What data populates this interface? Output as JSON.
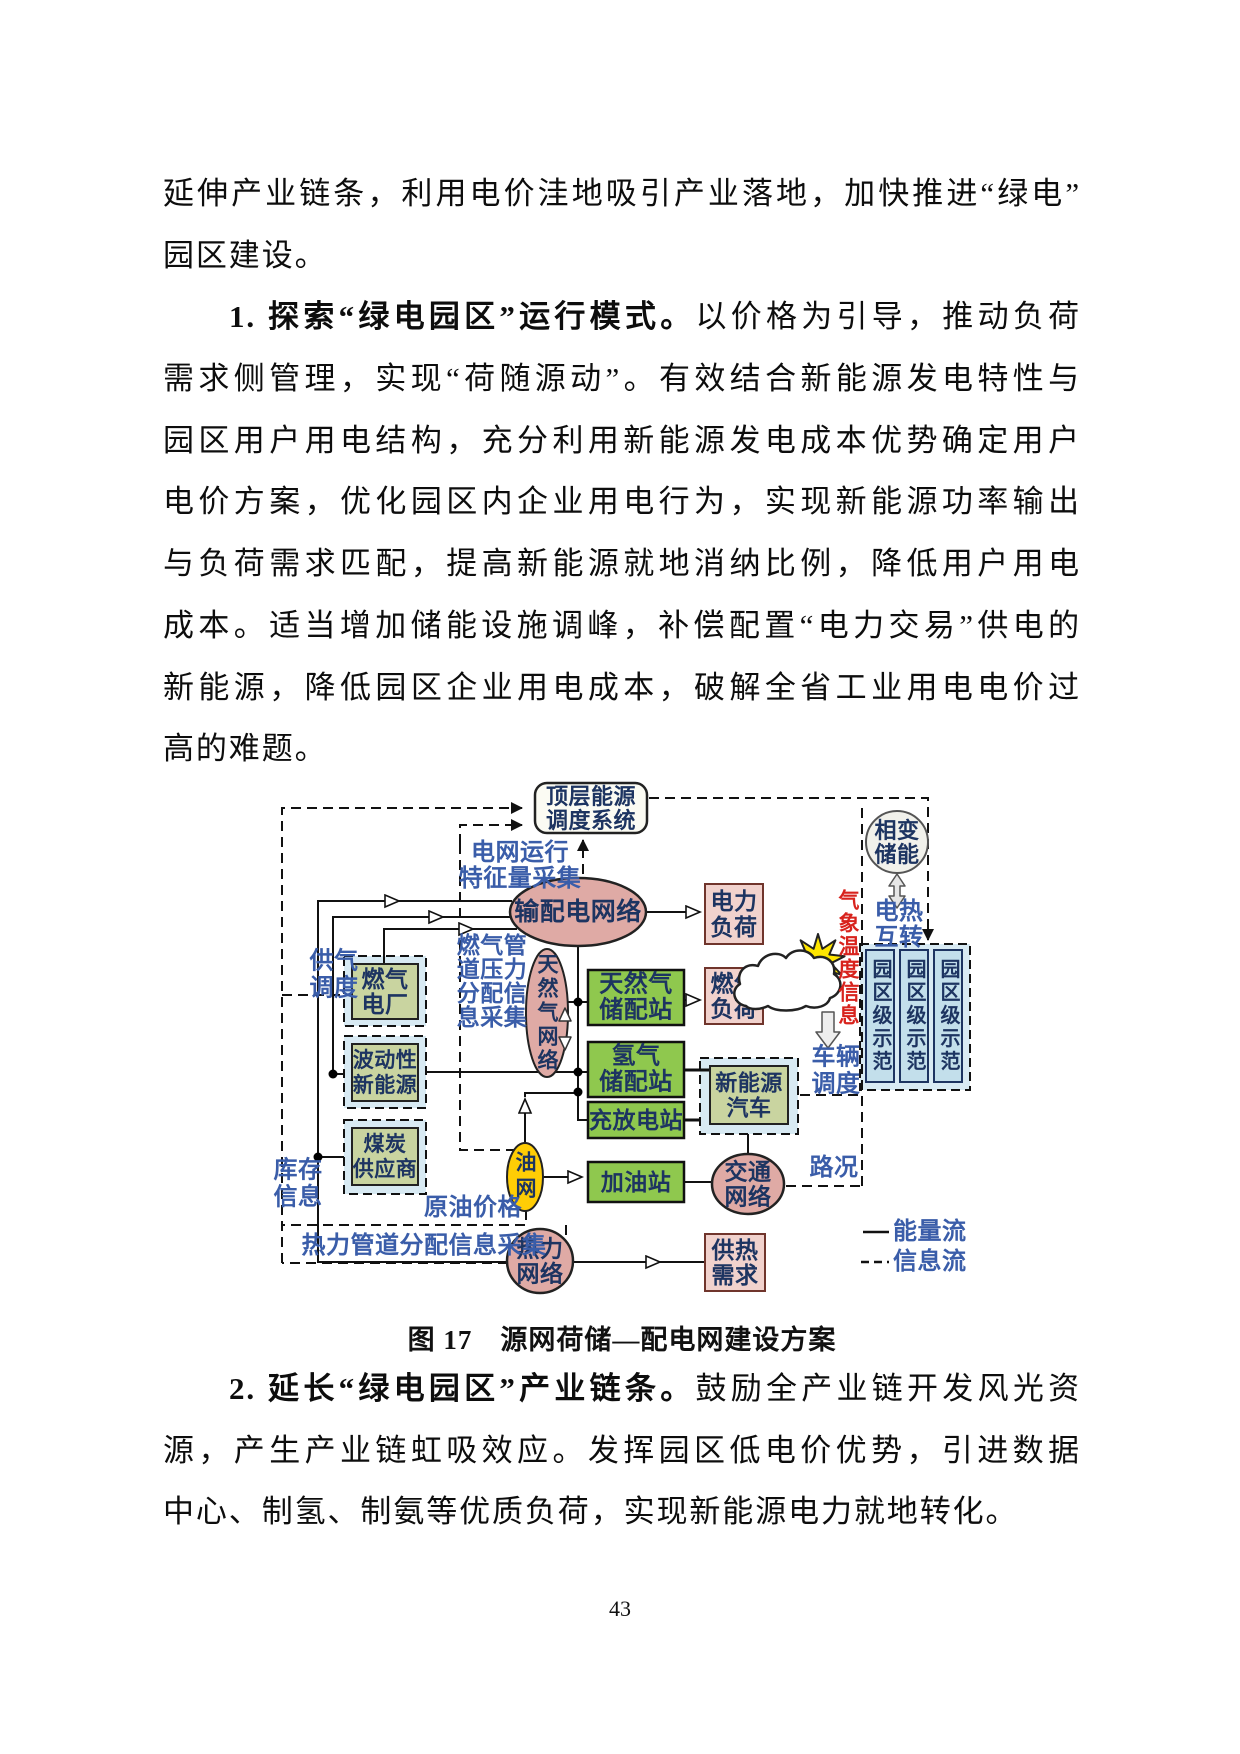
{
  "page": {
    "number": "43"
  },
  "body_text": {
    "top_lines": [
      {
        "segments": [
          {
            "t": "延伸产业链条，利用电价洼地吸引产业落地，加快推进“绿电”",
            "b": false
          }
        ],
        "indent": false,
        "last": false
      },
      {
        "segments": [
          {
            "t": "园区建设。",
            "b": false
          }
        ],
        "indent": false,
        "last": true
      },
      {
        "segments": [
          {
            "t": "1. 探索“绿电园区”运行模式。",
            "b": true
          },
          {
            "t": "以价格为引导，推动负荷",
            "b": false
          }
        ],
        "indent": true,
        "last": false
      },
      {
        "segments": [
          {
            "t": "需求侧管理，实现“荷随源动”。有效结合新能源发电特性与",
            "b": false
          }
        ],
        "indent": false,
        "last": false
      },
      {
        "segments": [
          {
            "t": "园区用户用电结构，充分利用新能源发电成本优势确定用户",
            "b": false
          }
        ],
        "indent": false,
        "last": false
      },
      {
        "segments": [
          {
            "t": "电价方案，优化园区内企业用电行为，实现新能源功率输出",
            "b": false
          }
        ],
        "indent": false,
        "last": false
      },
      {
        "segments": [
          {
            "t": "与负荷需求匹配，提高新能源就地消纳比例，降低用户用电",
            "b": false
          }
        ],
        "indent": false,
        "last": false
      },
      {
        "segments": [
          {
            "t": "成本。适当增加储能设施调峰，补偿配置“电力交易”供电的",
            "b": false
          }
        ],
        "indent": false,
        "last": false
      },
      {
        "segments": [
          {
            "t": "新能源，降低园区企业用电成本，破解全省工业用电电价过",
            "b": false
          }
        ],
        "indent": false,
        "last": false
      },
      {
        "segments": [
          {
            "t": "高的难题。",
            "b": false
          }
        ],
        "indent": false,
        "last": true
      }
    ],
    "bottom_lines": [
      {
        "segments": [
          {
            "t": "2. 延长“绿电园区”产业链条。",
            "b": true
          },
          {
            "t": "鼓励全产业链开发风光资",
            "b": false
          }
        ],
        "indent": true,
        "last": false
      },
      {
        "segments": [
          {
            "t": "源，产生产业链虹吸效应。发挥园区低电价优势，引进数据",
            "b": false
          }
        ],
        "indent": false,
        "last": false
      },
      {
        "segments": [
          {
            "t": "中心、制氢、制氨等优质负荷，实现新能源电力就地转化。",
            "b": false
          }
        ],
        "indent": false,
        "last": true
      }
    ]
  },
  "figure": {
    "caption": "图 17　源网荷储—配电网建设方案",
    "palette": {
      "pink_node": "#dfaaa5",
      "pink_box": "#f1d2cd",
      "pink_box_border": "#70352c",
      "green_box": "#8fc84e",
      "olive_box": "#c9d4a0",
      "container": "#d8eaf3",
      "demo_box": "#c3dfeb",
      "navy": "#1d3461",
      "blue": "#3a5da9",
      "red": "#d8231d",
      "yellow": "#ffcd05",
      "top_box": "#fbfbf3",
      "storage": "#f1f1eb"
    },
    "containers": [
      {
        "name": "gas-plant-container",
        "x": 344,
        "y": 956,
        "w": 82,
        "h": 70
      },
      {
        "name": "renewables-container",
        "x": 344,
        "y": 1036,
        "w": 82,
        "h": 72
      },
      {
        "name": "coal-container",
        "x": 344,
        "y": 1120,
        "w": 82,
        "h": 74
      },
      {
        "name": "ev-container",
        "x": 700,
        "y": 1058,
        "w": 98,
        "h": 76
      },
      {
        "name": "park-demo-container",
        "x": 860,
        "y": 944,
        "w": 110,
        "h": 146
      }
    ],
    "edges": [
      {
        "name": "info-outer-boundary",
        "d": "M282,1263 L282,808 L522,808",
        "kind": "info",
        "arrow": "filled"
      },
      {
        "name": "info-inner-boundary-arrow",
        "d": "M460,844 L460,825 L522,825",
        "kind": "info",
        "arrow": "filled"
      },
      {
        "name": "info-inner-boundary",
        "d": "M460,844 L460,1150 L526,1150 L526,1225 L282,1225",
        "kind": "info"
      },
      {
        "name": "info-label-box",
        "d": "M566,1225 L566,1263 L282,1263",
        "kind": "info"
      },
      {
        "name": "info-top-right",
        "d": "M649,798 L928,798 L928,940",
        "kind": "info",
        "arrow": "filled"
      },
      {
        "name": "info-right-boundary",
        "d": "M862,808 L862,1186",
        "kind": "info"
      },
      {
        "name": "info-traffic-link",
        "d": "M786,1186 L862,1186",
        "kind": "info"
      },
      {
        "name": "info-grid-feature-arrow",
        "d": "M583,874 L583,840",
        "kind": "info",
        "arrow": "filled"
      },
      {
        "name": "info-vehicle-link",
        "d": "M800,1095 L860,1095",
        "kind": "info"
      },
      {
        "name": "info-gas-supply-link",
        "d": "M282,995 L344,995",
        "kind": "info"
      },
      {
        "name": "energy-coal-riser",
        "d": "M318,1157 L318,901 L398,901",
        "kind": "energy",
        "arrow": "hollow"
      },
      {
        "name": "energy-coal-riser-2",
        "d": "M398,901 L512,901",
        "kind": "energy"
      },
      {
        "name": "energy-renew-riser",
        "d": "M333,1074 L333,917 L442,917",
        "kind": "energy",
        "arrow": "hollow"
      },
      {
        "name": "energy-renew-riser-2",
        "d": "M442,917 L514,917",
        "kind": "energy"
      },
      {
        "name": "energy-gasplant-up",
        "d": "M384,964 L384,929 L472,929",
        "kind": "energy",
        "arrow": "hollow"
      },
      {
        "name": "energy-gasplant-up-2",
        "d": "M472,929 L517,929",
        "kind": "energy"
      },
      {
        "name": "energy-renew-stub",
        "d": "M333,1074 L344,1074",
        "kind": "energy"
      },
      {
        "name": "energy-coal-stub",
        "d": "M318,1157 L344,1157",
        "kind": "energy"
      },
      {
        "name": "energy-left-down",
        "d": "M318,1157 L318,1262 L509,1262",
        "kind": "energy"
      },
      {
        "name": "energy-grid-to-load",
        "d": "M646,912 L699,912",
        "kind": "energy",
        "arrow": "hollow"
      },
      {
        "name": "energy-grid-down",
        "d": "M578,946 L578,1120 L588,1120",
        "kind": "energy"
      },
      {
        "name": "energy-gasnet-station",
        "d": "M568,1002 L588,1002",
        "kind": "energy"
      },
      {
        "name": "energy-renew-h2",
        "d": "M426,1072 L588,1072",
        "kind": "energy"
      },
      {
        "name": "energy-ngstation-gasload",
        "d": "M684,1000 L699,1000",
        "kind": "energy",
        "arrow": "hollow"
      },
      {
        "name": "energy-h2-vehicle",
        "d": "M684,1070 L710,1070",
        "kind": "energy",
        "w": 3
      },
      {
        "name": "energy-charge-vehicle",
        "d": "M684,1120 L700,1120",
        "kind": "energy",
        "w": 3
      },
      {
        "name": "energy-vehicle-traffic",
        "d": "M748,1134 L748,1155",
        "kind": "energy"
      },
      {
        "name": "energy-oil-up",
        "d": "M525,1143 L525,1100",
        "kind": "energy",
        "arrow": "hollow"
      },
      {
        "name": "energy-oil-up-2",
        "d": "M525,1097 L525,1093 L576,1093",
        "kind": "energy"
      },
      {
        "name": "energy-oil-fuelstation",
        "d": "M543,1177 L581,1177",
        "kind": "energy",
        "arrow": "hollow"
      },
      {
        "name": "energy-fuel-traffic",
        "d": "M684,1182 L713,1182",
        "kind": "energy"
      },
      {
        "name": "energy-heat-demand",
        "d": "M573,1262 L659,1262",
        "kind": "energy",
        "arrow": "hollow"
      },
      {
        "name": "energy-heat-demand-2",
        "d": "M659,1262 L705,1262",
        "kind": "energy"
      }
    ],
    "dots": [
      [
        333,
        1074
      ],
      [
        318,
        1157
      ],
      [
        578,
        1002
      ],
      [
        578,
        1072
      ],
      [
        578,
        1092
      ]
    ],
    "nodes": [
      {
        "name": "top-dispatch-system",
        "shape": "roundrect",
        "x": 535,
        "y": 783,
        "w": 112,
        "h": 50,
        "rx": 12,
        "fill": "top_box",
        "stroke": "#222",
        "sw": 2.5,
        "lines": [
          "顶层能源",
          "调度系统"
        ],
        "fs": 22,
        "lh": 24
      },
      {
        "name": "grid-network",
        "shape": "ellipse",
        "cx": 578,
        "cy": 912,
        "rx": 68,
        "ry": 34,
        "fill": "pink_node",
        "stroke": "#222",
        "sw": 2.5,
        "lines": [
          "输配电网络"
        ],
        "fs": 25,
        "lh": 26
      },
      {
        "name": "power-load",
        "shape": "rect",
        "x": 705,
        "y": 884,
        "w": 58,
        "h": 60,
        "fill": "pink_box",
        "stroke": "#70352c",
        "sw": 2,
        "lines": [
          "电力",
          "负荷"
        ],
        "fs": 23,
        "lh": 26
      },
      {
        "name": "gas-load",
        "shape": "rect",
        "x": 705,
        "y": 968,
        "w": 58,
        "h": 56,
        "fill": "pink_box",
        "stroke": "#70352c",
        "sw": 2,
        "lines": [
          "燃气",
          "负荷"
        ],
        "fs": 23,
        "lh": 25
      },
      {
        "name": "heat-demand",
        "shape": "rect",
        "x": 705,
        "y": 1234,
        "w": 60,
        "h": 57,
        "fill": "pink_box",
        "stroke": "#70352c",
        "sw": 2,
        "lines": [
          "供热",
          "需求"
        ],
        "fs": 23,
        "lh": 25
      },
      {
        "name": "naturalgas-network",
        "shape": "ellipse",
        "cx": 547,
        "cy": 1013,
        "rx": 21,
        "ry": 64,
        "fill": "pink_node",
        "stroke": "#222",
        "sw": 2,
        "lines": [
          "天然气网络"
        ],
        "fs": 21,
        "vertical": true,
        "ls": 3
      },
      {
        "name": "naturalgas-station",
        "shape": "rect",
        "x": 588,
        "y": 970,
        "w": 96,
        "h": 55,
        "fill": "green_box",
        "stroke": "#111",
        "sw": 2.5,
        "lines": [
          "天然气",
          "储配站"
        ],
        "fs": 24,
        "lh": 26
      },
      {
        "name": "hydrogen-station",
        "shape": "rect",
        "x": 588,
        "y": 1042,
        "w": 96,
        "h": 55,
        "fill": "green_box",
        "stroke": "#111",
        "sw": 2.5,
        "lines": [
          "氢气",
          "储配站"
        ],
        "fs": 24,
        "lh": 26
      },
      {
        "name": "charge-station",
        "shape": "rect",
        "x": 588,
        "y": 1102,
        "w": 96,
        "h": 36,
        "fill": "green_box",
        "stroke": "#111",
        "sw": 2.5,
        "lines": [
          "充放电站"
        ],
        "fs": 23,
        "lh": 24
      },
      {
        "name": "fuel-station",
        "shape": "rect",
        "x": 588,
        "y": 1162,
        "w": 96,
        "h": 40,
        "fill": "green_box",
        "stroke": "#111",
        "sw": 2.5,
        "lines": [
          "加油站"
        ],
        "fs": 23,
        "lh": 24
      },
      {
        "name": "gas-power-plant",
        "shape": "rect",
        "x": 352,
        "y": 964,
        "w": 66,
        "h": 55,
        "fill": "olive_box",
        "stroke": "#222",
        "sw": 2,
        "lines": [
          "燃气",
          "电厂"
        ],
        "fs": 23,
        "lh": 25
      },
      {
        "name": "fluctuating-renewables",
        "shape": "rect",
        "x": 352,
        "y": 1044,
        "w": 66,
        "h": 57,
        "fill": "olive_box",
        "stroke": "#222",
        "sw": 2,
        "lines": [
          "波动性",
          "新能源"
        ],
        "fs": 21,
        "lh": 25
      },
      {
        "name": "coal-supplier",
        "shape": "rect",
        "x": 352,
        "y": 1128,
        "w": 66,
        "h": 57,
        "fill": "olive_box",
        "stroke": "#222",
        "sw": 2,
        "lines": [
          "煤炭",
          "供应商"
        ],
        "fs": 21,
        "lh": 25
      },
      {
        "name": "new-energy-vehicle",
        "shape": "rect",
        "x": 710,
        "y": 1066,
        "w": 78,
        "h": 58,
        "fill": "olive_box",
        "stroke": "#222",
        "sw": 2,
        "lines": [
          "新能源",
          "汽车"
        ],
        "fs": 22,
        "lh": 25
      },
      {
        "name": "oil-network",
        "shape": "ellipse",
        "cx": 525,
        "cy": 1177,
        "rx": 18,
        "ry": 34,
        "fill": "yellow",
        "stroke": "#222",
        "sw": 2,
        "lines": [
          "油网"
        ],
        "fs": 21,
        "vertical": true,
        "ls": 5
      },
      {
        "name": "traffic-network",
        "shape": "ellipse",
        "cx": 748,
        "cy": 1184,
        "rx": 36,
        "ry": 30,
        "fill": "pink_node",
        "stroke": "#222",
        "sw": 2.5,
        "lines": [
          "交通",
          "网络"
        ],
        "fs": 23,
        "lh": 25
      },
      {
        "name": "heat-network",
        "shape": "ellipse",
        "cx": 540,
        "cy": 1261,
        "rx": 33,
        "ry": 32,
        "fill": "pink_node",
        "stroke": "#222",
        "sw": 2.5,
        "lines": [
          "热力",
          "网络"
        ],
        "fs": 23,
        "lh": 25
      },
      {
        "name": "phase-change-storage",
        "shape": "circle",
        "cx": 897,
        "cy": 842,
        "r": 31,
        "fill": "storage",
        "stroke": "#555",
        "sw": 2,
        "lines": [
          "相变",
          "储能"
        ],
        "fs": 22,
        "lh": 24
      },
      {
        "name": "park-demo-1",
        "shape": "rect",
        "x": 866,
        "y": 950,
        "w": 28,
        "h": 132,
        "fill": "demo_box",
        "stroke": "#1d3461",
        "sw": 2,
        "lines": [
          "园区级示范"
        ],
        "fs": 20,
        "vertical": true,
        "ls": 3
      },
      {
        "name": "park-demo-2",
        "shape": "rect",
        "x": 900,
        "y": 950,
        "w": 28,
        "h": 132,
        "fill": "demo_box",
        "stroke": "#1d3461",
        "sw": 2,
        "lines": [
          "园区级示范"
        ],
        "fs": 20,
        "vertical": true,
        "ls": 3
      },
      {
        "name": "park-demo-3",
        "shape": "rect",
        "x": 934,
        "y": 950,
        "w": 28,
        "h": 132,
        "fill": "demo_box",
        "stroke": "#1d3461",
        "sw": 2,
        "lines": [
          "园区级示范"
        ],
        "fs": 20,
        "vertical": true,
        "ls": 3
      }
    ],
    "labels": [
      {
        "name": "label-grid-feature-collection",
        "x": 520,
        "y": 866,
        "lines": [
          "电网运行",
          "特征量采集"
        ],
        "color": "blue",
        "fs": 24,
        "lh": 26
      },
      {
        "name": "label-gas-supply-dispatch",
        "x": 334,
        "y": 975,
        "lines": [
          "供气",
          "调度"
        ],
        "color": "blue",
        "fs": 24,
        "lh": 27
      },
      {
        "name": "label-gas-pipeline-info",
        "x": 492,
        "y": 981,
        "lines": [
          "燃气管",
          "道压力",
          "分配信",
          "息采集"
        ],
        "color": "blue",
        "fs": 23,
        "lh": 24
      },
      {
        "name": "label-inventory-info",
        "x": 298,
        "y": 1184,
        "lines": [
          "库存",
          "信息"
        ],
        "color": "blue",
        "fs": 24,
        "lh": 27
      },
      {
        "name": "label-crude-oil-price",
        "x": 473,
        "y": 1208,
        "lines": [
          "原油价格"
        ],
        "color": "blue",
        "fs": 24,
        "lh": 26
      },
      {
        "name": "label-heat-pipeline-info",
        "x": 424,
        "y": 1246,
        "lines": [
          "热力管道分配信息采集"
        ],
        "color": "blue",
        "fs": 24,
        "lh": 26
      },
      {
        "name": "label-vehicle-dispatch",
        "x": 836,
        "y": 1071,
        "lines": [
          "车辆",
          "调度"
        ],
        "color": "blue",
        "fs": 24,
        "lh": 27
      },
      {
        "name": "label-electric-heat-convert",
        "x": 899,
        "y": 925,
        "lines": [
          "电热",
          "互转"
        ],
        "color": "blue",
        "fs": 24,
        "lh": 26
      },
      {
        "name": "label-road-condition",
        "x": 834,
        "y": 1168,
        "lines": [
          "路况"
        ],
        "color": "blue",
        "fs": 24,
        "lh": 26
      },
      {
        "name": "label-weather-temperature-info",
        "x": 848,
        "y": 958,
        "lines": [
          "气象温度信息"
        ],
        "color": "red",
        "fs": 21,
        "vertical": true,
        "ls": 2
      },
      {
        "name": "legend-energy-flow-label",
        "x": 893,
        "y": 1232,
        "lines": [
          "能量流"
        ],
        "color": "blue",
        "fs": 24,
        "lh": 26,
        "anchor": "start"
      },
      {
        "name": "legend-info-flow-label",
        "x": 893,
        "y": 1262,
        "lines": [
          "信息流"
        ],
        "color": "blue",
        "fs": 24,
        "lh": 26,
        "anchor": "start"
      }
    ],
    "shapes": [
      {
        "name": "sun-icon",
        "type": "star",
        "cx": 818,
        "cy": 961,
        "r1": 13,
        "r2": 27,
        "points": 9,
        "fill": "#ffe600",
        "stroke": "#222",
        "sw": 2
      },
      {
        "name": "cloud-icon",
        "type": "path",
        "d": "M746,1006 C734,1004 730,990 740,984 C736,972 746,962 758,966 C762,954 778,950 786,958 C792,948 808,948 814,958 C826,954 836,962 834,974 C844,980 842,994 830,998 C828,1006 816,1010 806,1006 C796,1012 776,1012 768,1006 C760,1010 750,1010 746,1006 Z",
        "fill": "#ffffff",
        "stroke": "#222",
        "sw": 2.5
      },
      {
        "name": "phase-storage-double-arrow",
        "type": "path",
        "d": "M897,874 L905,886 L900,886 L900,896 L905,896 L897,908 L889,896 L894,896 L894,886 L889,886 Z",
        "fill": "#e6e6e6",
        "stroke": "#555",
        "sw": 1.5
      },
      {
        "name": "vehicle-dispatch-down-arrow",
        "type": "path",
        "d": "M822,1012 L834,1012 L834,1032 L840,1032 L828,1048 L816,1032 L822,1032 Z",
        "fill": "#eeeeee",
        "stroke": "#555",
        "sw": 1.5
      },
      {
        "name": "gasnet-up-arrow",
        "type": "path",
        "d": "M565,1008 L571,1021 L559,1021 Z",
        "fill": "#ffffff",
        "stroke": "#333",
        "sw": 1.5
      },
      {
        "name": "gasnet-down-arrow",
        "type": "path",
        "d": "M565,1050 L571,1037 L559,1037 Z",
        "fill": "#ffffff",
        "stroke": "#333",
        "sw": 1.5
      },
      {
        "name": "legend-energy-line",
        "type": "path",
        "d": "M863,1232 L889,1232",
        "fill": "none",
        "stroke": "#111",
        "sw": 2.5
      },
      {
        "name": "legend-info-line",
        "type": "path",
        "d": "M861,1262 L889,1262",
        "fill": "none",
        "stroke": "#111",
        "sw": 2.5,
        "dash": "8 5"
      }
    ]
  }
}
